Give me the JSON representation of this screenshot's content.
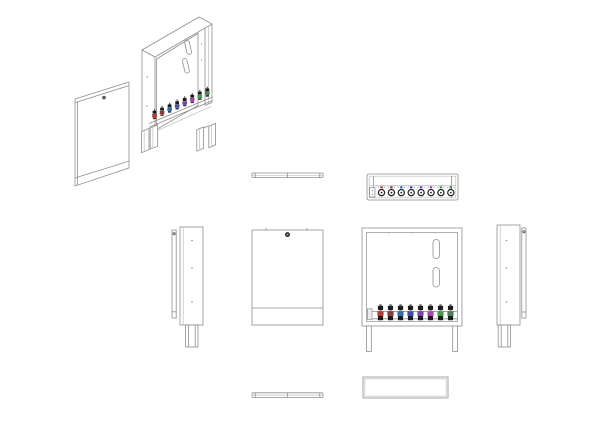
{
  "drawing": {
    "background": "#ffffff",
    "stroke": "#8e8e8e",
    "stroke_light": "#bdbdbd",
    "stroke_dark": "#4b4b4b",
    "cap_color": "#1d1d1d",
    "bracket_fill": "#ececec",
    "circuit_count": 8,
    "circuit_colors": [
      "#c0392b",
      "#8e3a3a",
      "#2f6fb0",
      "#3d4db5",
      "#7a3fb5",
      "#b13fb5",
      "#3f9e4f",
      "#4f7f55"
    ],
    "views": {
      "iso": "exploded-isometric-view",
      "door_top": "door-top-view",
      "cabinet_top": "cabinet-top-view",
      "side_left": "left-side-view",
      "door_front": "door-front-view",
      "cabinet_front": "cabinet-front-view",
      "side_right": "right-side-view",
      "door_bottom": "door-bottom-view",
      "cabinet_bottom": "cabinet-bottom-view"
    }
  }
}
